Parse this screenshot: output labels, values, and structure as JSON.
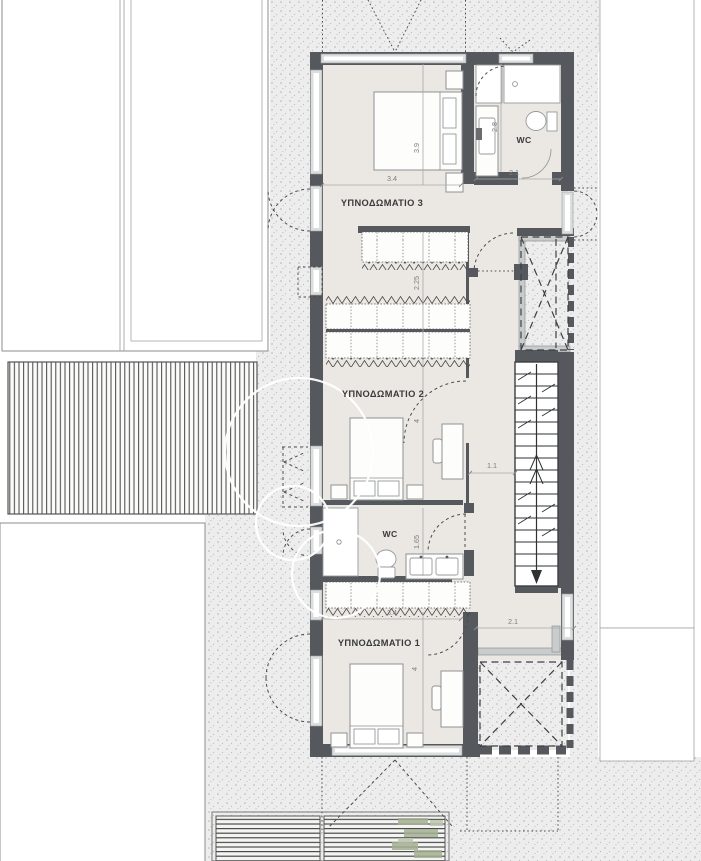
{
  "plan": {
    "rooms": [
      {
        "id": "bedroom-3",
        "label": "ΥΠΝΟΔΩΜΑΤΙΟ 3"
      },
      {
        "id": "bedroom-2",
        "label": "ΥΠΝΟΔΩΜΑΤΙΟ 2"
      },
      {
        "id": "bedroom-1",
        "label": "ΥΠΝΟΔΩΜΑΤΙΟ 1"
      },
      {
        "id": "wc-top",
        "label": "WC"
      },
      {
        "id": "wc-middle",
        "label": "WC"
      }
    ],
    "dimensions": [
      {
        "id": "bedroom3-depth",
        "value": "3.9"
      },
      {
        "id": "bedroom3-width",
        "value": "3.4"
      },
      {
        "id": "wc-top-depth",
        "value": "2.8"
      },
      {
        "id": "wc-top-width",
        "value": "2.1"
      },
      {
        "id": "dressing-depth",
        "value": "2.25"
      },
      {
        "id": "bedroom2-depth",
        "value": "4"
      },
      {
        "id": "hall-width",
        "value": "1.1"
      },
      {
        "id": "wc-middle-depth",
        "value": "1.65"
      },
      {
        "id": "bedroom1-width",
        "value": "3.4"
      },
      {
        "id": "hall-bottom-width",
        "value": "2.1"
      },
      {
        "id": "bedroom1-depth",
        "value": "4"
      }
    ],
    "colors": {
      "wall": "#55585c",
      "floor": "#ebe8e3",
      "paving": "#ecedec",
      "plant_green": "#a3b093",
      "dash": "#4a4a4a"
    }
  }
}
